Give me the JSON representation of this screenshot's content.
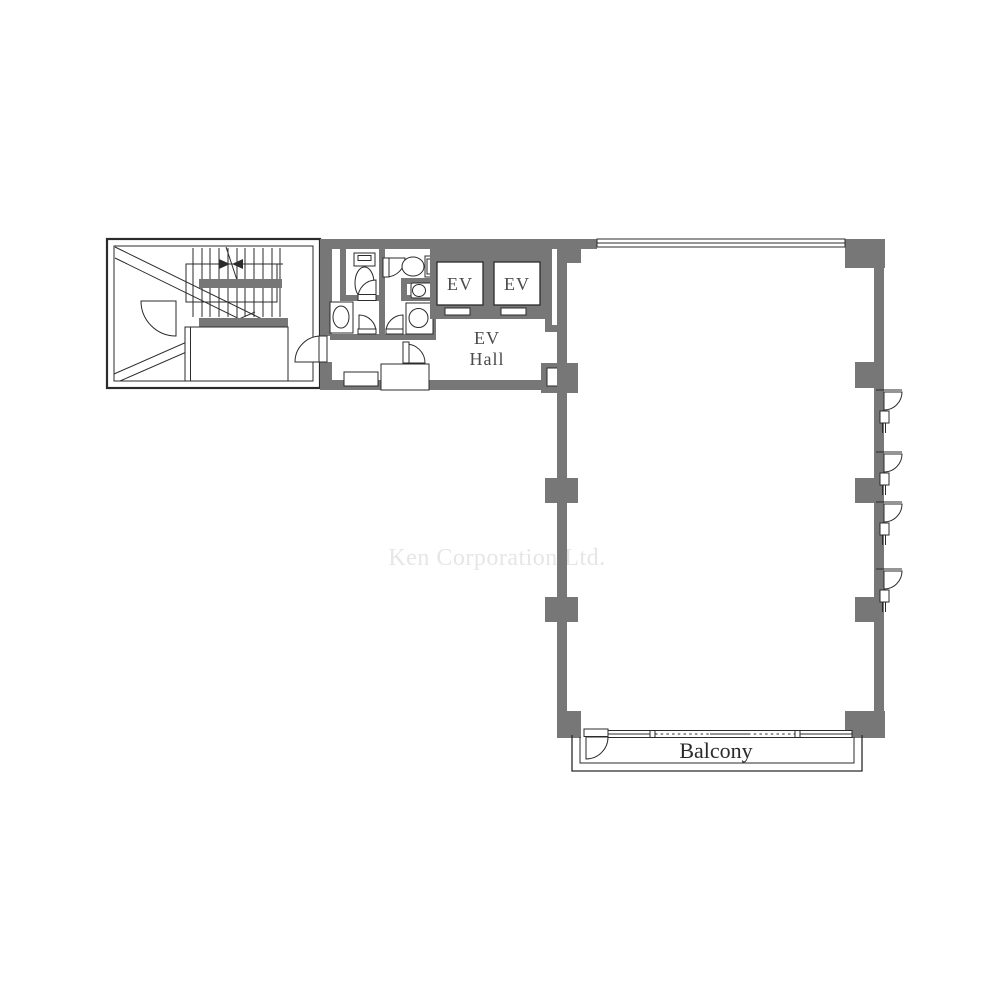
{
  "colors": {
    "wall": "#777777",
    "line": "#2b2b2b",
    "label": "#4a4a4a",
    "label_dark": "#2b2b2b",
    "watermark": "#e6e6e6",
    "background": "#ffffff"
  },
  "labels": {
    "elevator_1": "EV",
    "elevator_2": "EV",
    "ev_hall": {
      "line1": "EV",
      "line2": "Hall"
    },
    "balcony": "Balcony",
    "watermark": "Ken Corporation Ltd."
  }
}
